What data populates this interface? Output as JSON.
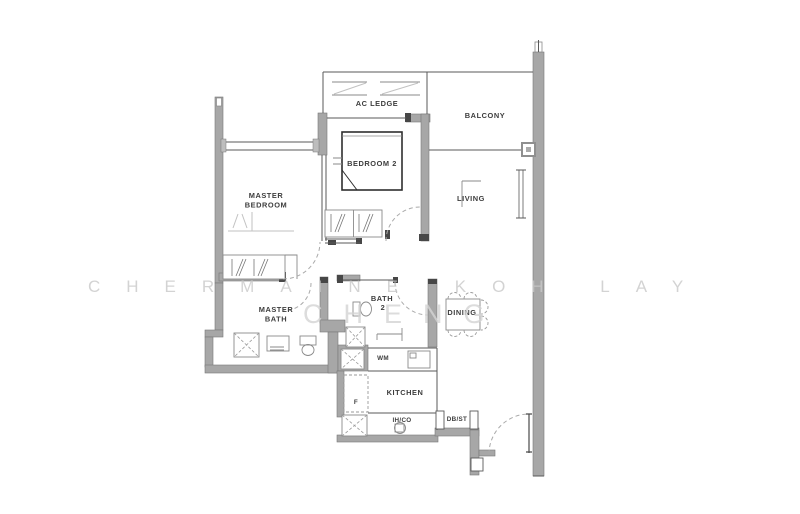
{
  "watermark": {
    "line1": "CHERMAINE KOH LAY",
    "line2": "CHENG"
  },
  "rooms": {
    "ac_ledge": "AC LEDGE",
    "balcony": "BALCONY",
    "bedroom2": "BEDROOM 2",
    "master_bedroom_line1": "MASTER",
    "master_bedroom_line2": "BEDROOM",
    "living": "LIVING",
    "master_bath_line1": "MASTER",
    "master_bath_line2": "BATH",
    "bath2_line1": "BATH",
    "bath2_line2": "2",
    "dining": "DINING",
    "kitchen": "KITCHEN"
  },
  "fixtures": {
    "washing_machine": "WM",
    "fridge": "F",
    "induction_hob": "IH/CO",
    "db_store": "DB/ST"
  },
  "colors": {
    "wall_gray": "#a7a7a7",
    "wall_cap_dark": "#474747",
    "line": "#5a5a5a",
    "watermark_light": "#c9c9c9",
    "label_text": "#3d3d3d",
    "background": "#ffffff"
  }
}
